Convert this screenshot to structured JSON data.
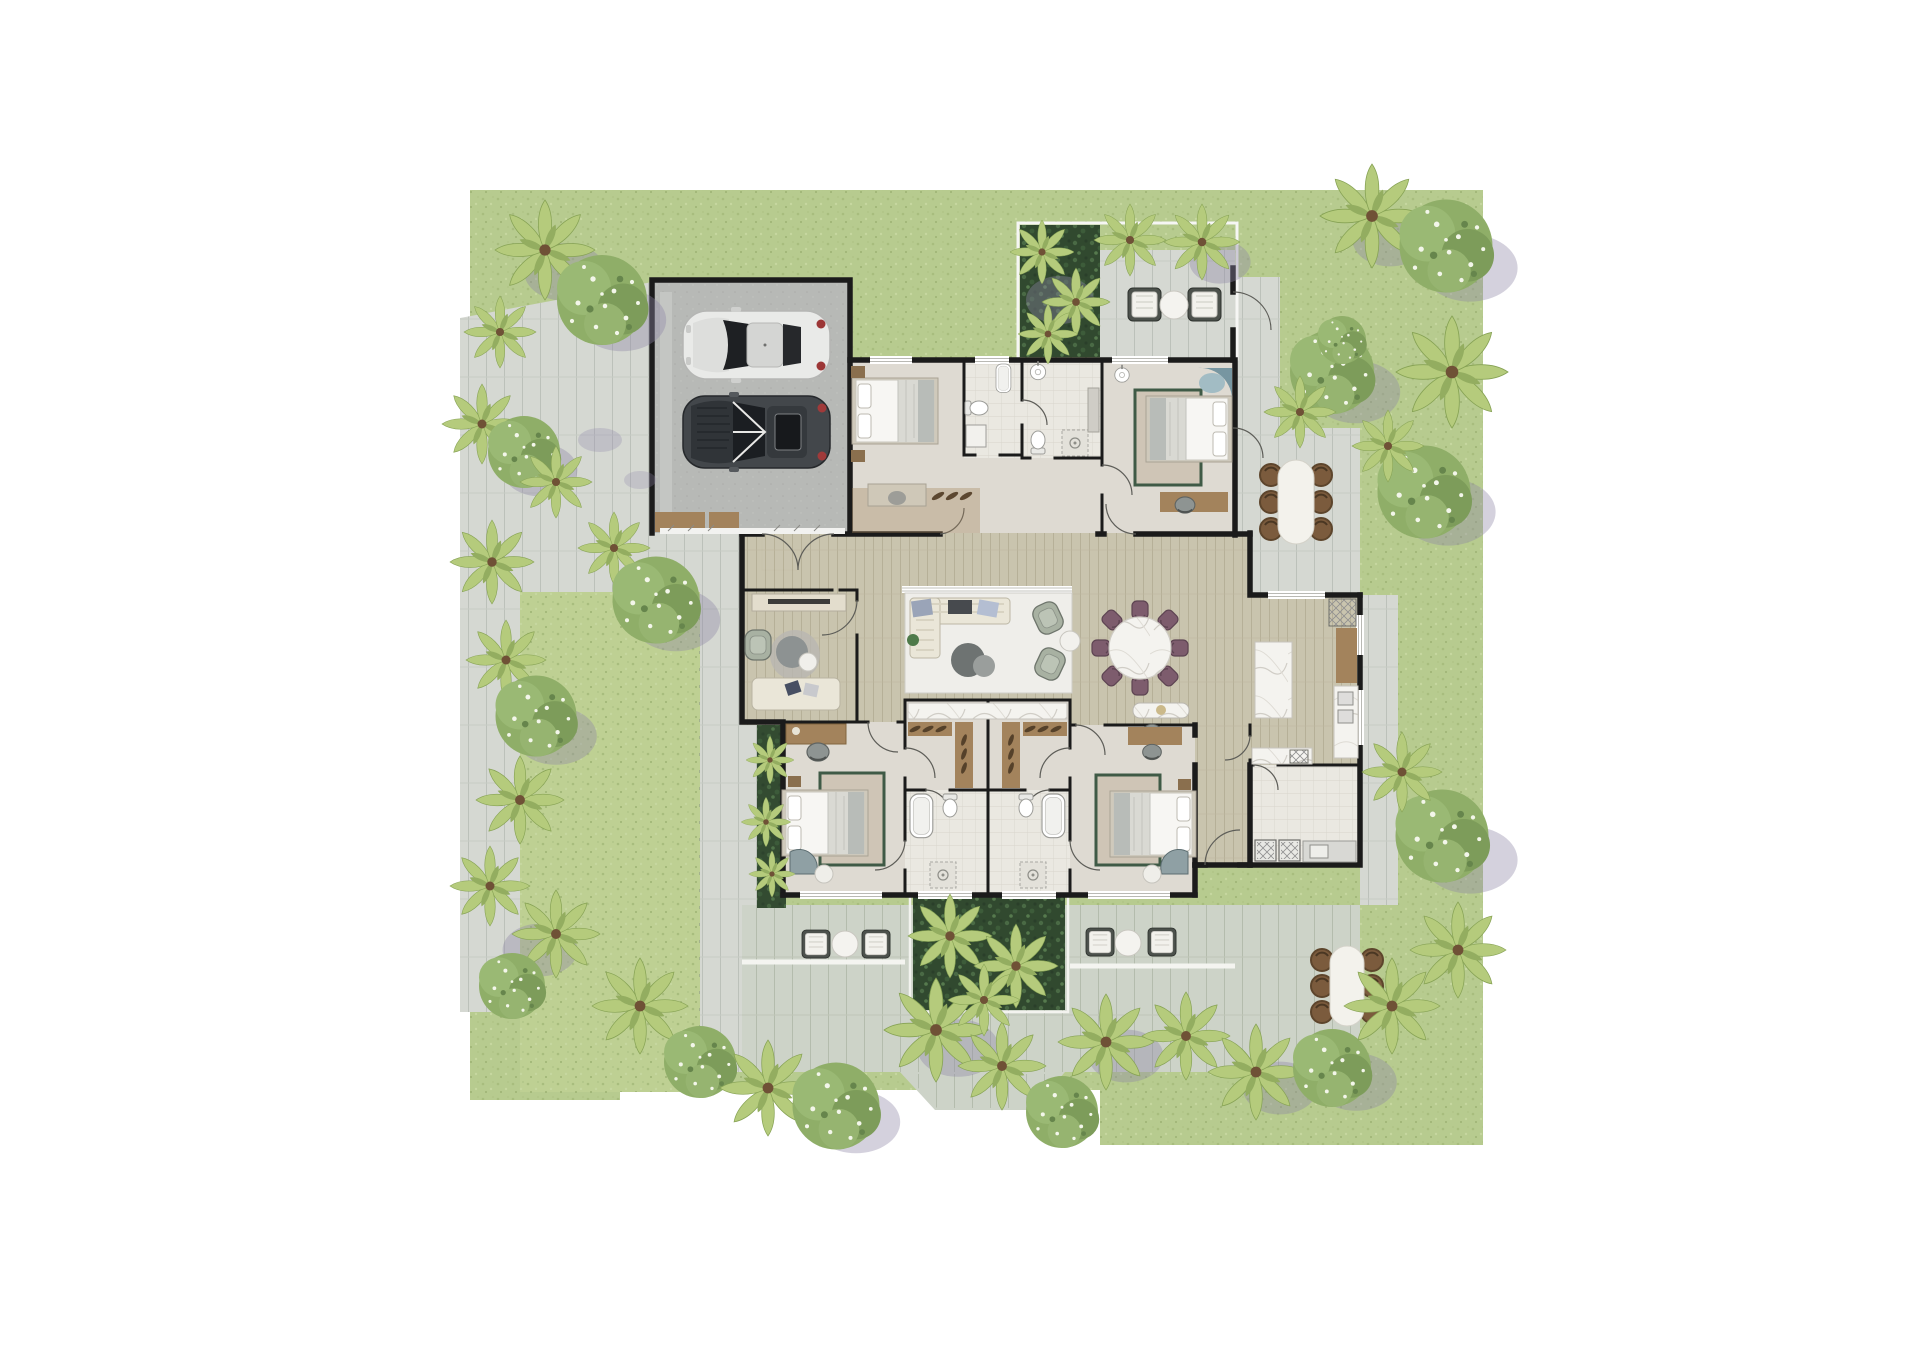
{
  "plan": {
    "type": "residential-site-plan-top-view",
    "counts": {
      "cars": 2,
      "beds": 4,
      "indoor_dining_chairs": 8,
      "outdoor_dining_tables": 2,
      "patio_lounge_sets": 3,
      "garage_bays": 2
    }
  },
  "palette": {
    "bg": "#ffffff",
    "lawn": "#b7cb8f",
    "lawn_side": "#bed093",
    "pavers": "#d5d8d2",
    "terrace": "#cdd3c8",
    "concrete": "#b7b9b6",
    "deck": "#c9c4ae",
    "wood_brown": "#a3835c",
    "floor_bedroom": "#dedad2",
    "floor_tile": "#eae8e1",
    "courtyard": "#31492f",
    "plant_bed": "#3a5538",
    "wall": "#1b1b1b",
    "marble": "#f4f3ef",
    "sofa_cream": "#eae6d8",
    "rug_light": "#efeeea",
    "rug_bed": "#cfc5b6",
    "rug_border": "#3f5a46",
    "armchair_sage": "#a8b1a2",
    "chair_plum": "#7d5c6d",
    "chair_brown": "#7b5b3d",
    "tub_teal": "#7796a1",
    "car_white": "#e9eae8",
    "car_dark": "#43474b",
    "palm_green": "#b5cb7c",
    "flower_green": "#8fae68",
    "shadow": "#8d86a6"
  }
}
